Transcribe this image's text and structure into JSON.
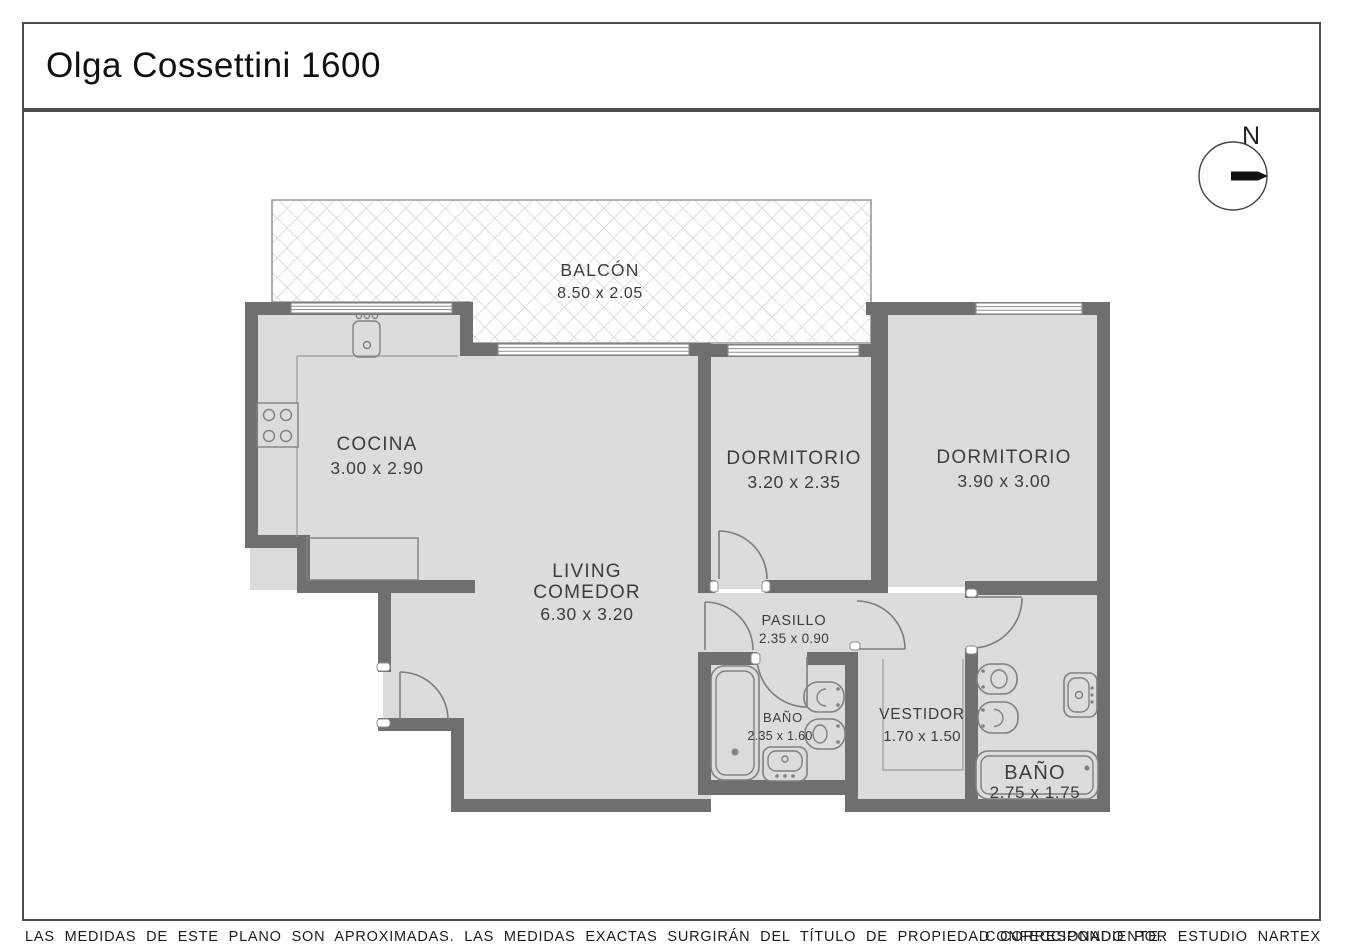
{
  "title": "Olga Cossettini 1600",
  "compass_label": "N",
  "rooms": {
    "balcon": {
      "name": "BALCÓN",
      "dims": "8.50 x 2.05"
    },
    "cocina": {
      "name": "COCINA",
      "dims": "3.00 x 2.90"
    },
    "living": {
      "line1": "LIVING",
      "line2": "COMEDOR",
      "dims": "6.30 x 3.20"
    },
    "dormitorio1": {
      "name": "DORMITORIO",
      "dims": "3.20 x 2.35"
    },
    "dormitorio2": {
      "name": "DORMITORIO",
      "dims": "3.90 x 3.00"
    },
    "pasillo": {
      "name": "PASILLO",
      "dims": "2.35 x 0.90"
    },
    "bano1": {
      "name": "BAÑO",
      "dims": "2.35 x 1.60"
    },
    "vestidor": {
      "name": "VESTIDOR",
      "dims": "1.70 x 1.50"
    },
    "bano2": {
      "name": "BAÑO",
      "dims": "2.75 x 1.75"
    }
  },
  "footer": {
    "disclaimer": "LAS MEDIDAS DE ESTE PLANO SON APROXIMADAS. LAS MEDIDAS EXACTAS SURGIRÁN DEL TÍTULO DE PROPIEDAD CORRESPONDIENTE.",
    "credit": "CONFECCIONADO POR ESTUDIO NARTEX"
  },
  "colors": {
    "wall": "#6f6f6f",
    "floor": "#dcdcdc",
    "accent_text": "#3d3d3d"
  }
}
